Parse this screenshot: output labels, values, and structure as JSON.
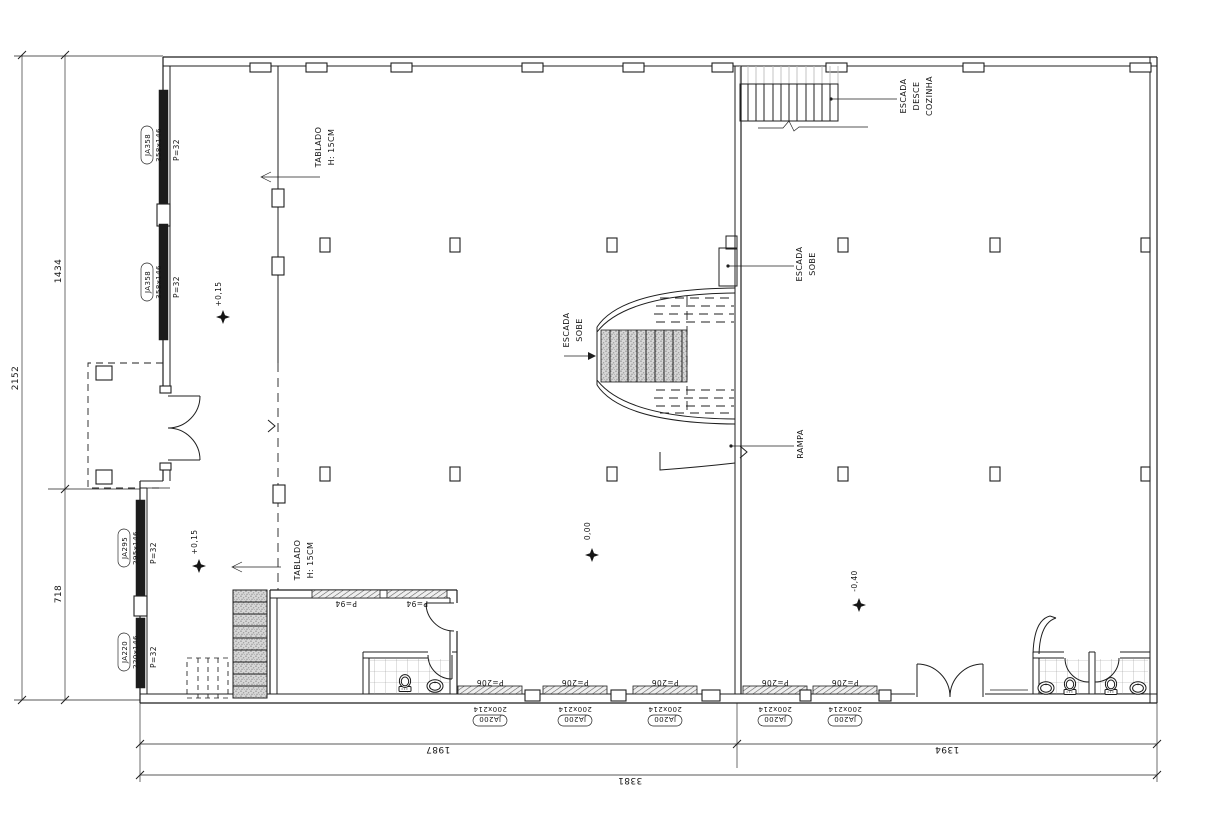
{
  "plan": {
    "annotations": {
      "tablado_upper": [
        "TABLADO",
        "H: 15CM"
      ],
      "tablado_lower": [
        "TABLADO",
        "H: 15CM"
      ],
      "stair_kitchen": [
        "ESCADA",
        "DESCE",
        "COZINHA"
      ],
      "stair_up_center": [
        "ESCADA",
        "SOBE"
      ],
      "stair_up_wall": [
        "ESCADA",
        "SOBE"
      ],
      "ramp": "RAMPA"
    },
    "levels": {
      "tablado_upper": "+0,15",
      "tablado_lower": "+0,15",
      "main_hall": "0,00",
      "right_hall": "-0,40"
    },
    "windows_left": [
      {
        "tag": "JA358",
        "size": "358x146",
        "sill": "P=32"
      },
      {
        "tag": "JA358",
        "size": "358x146",
        "sill": "P=32"
      },
      {
        "tag": "JA295",
        "size": "295x146",
        "sill": "P=32"
      },
      {
        "tag": "JA220",
        "size": "220x146",
        "sill": "P=32"
      }
    ],
    "windows_bottom": [
      {
        "tag": "JA200",
        "size": "200x214",
        "sill": "P=206"
      },
      {
        "tag": "JA200",
        "size": "200x214",
        "sill": "P=206"
      },
      {
        "tag": "JA200",
        "size": "200x214",
        "sill": "P=206"
      },
      {
        "tag": "JA200",
        "size": "200x214",
        "sill": "P=206"
      },
      {
        "tag": "JA200",
        "size": "200x214",
        "sill": "P=206"
      }
    ],
    "doors_room": [
      "P=94",
      "P=94"
    ],
    "dimensions": {
      "left_total": "2152",
      "left_upper": "1434",
      "left_lower": "718",
      "bottom_left": "1987",
      "bottom_right": "1394",
      "bottom_total": "3381"
    }
  }
}
